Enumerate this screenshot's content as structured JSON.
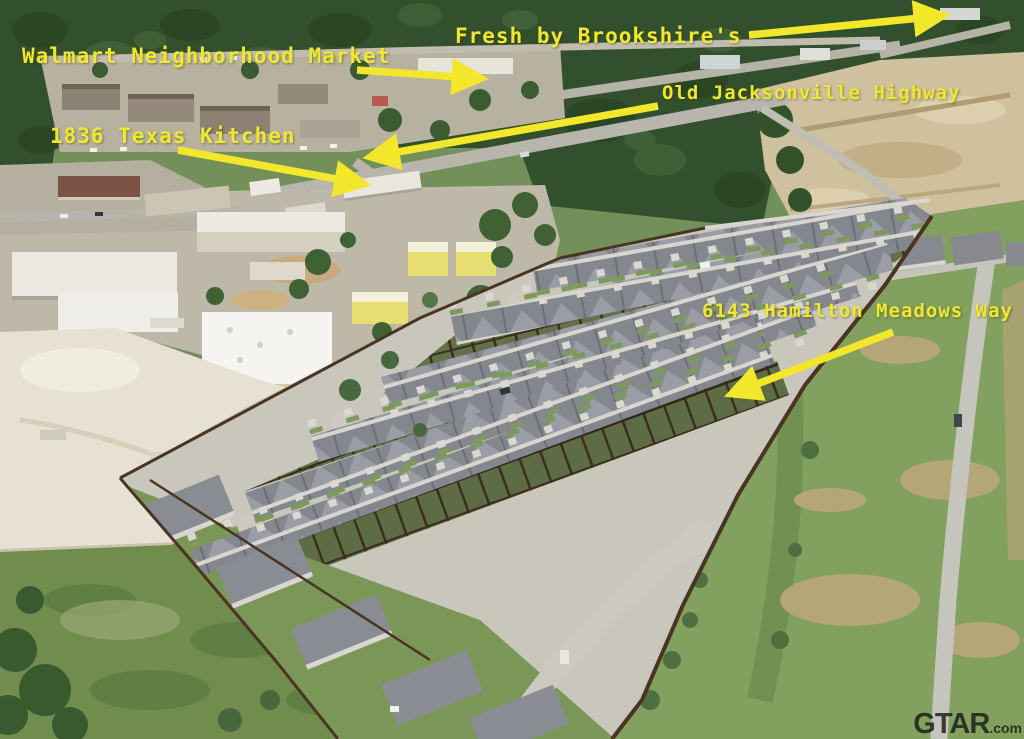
{
  "photo": {
    "kind": "aerial-drone-photo",
    "scene": "new single-story subdivision with gray roofs beside commercial corridor, tree line, cleared dirt lot and green fields"
  },
  "annotations": {
    "fresh_by_brookshires": {
      "label": "Fresh by Brookshire's"
    },
    "walmart_neighborhood_market": {
      "label": "Walmart Neighborhood Market"
    },
    "old_jacksonville_highway": {
      "label": "Old Jacksonville Highway"
    },
    "texas_kitchen_1836": {
      "label": "1836 Texas Kitchen"
    },
    "hamilton_meadows_way": {
      "label": "6143 Hamilton Meadows Way"
    }
  },
  "watermark": {
    "brand": "GTAR",
    "suffix": ".com"
  },
  "colors": {
    "annotation_yellow": "#f0e82e",
    "arrow_yellow": "#f2e72b",
    "watermark_dark": "#1a1a1a"
  }
}
